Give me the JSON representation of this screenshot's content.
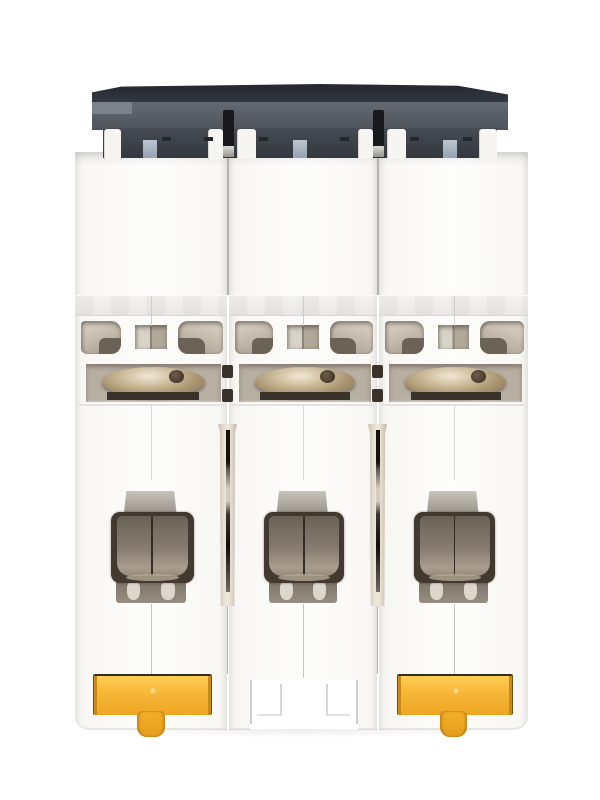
{
  "product": {
    "title": "Three-pole miniature circuit breaker, bottom view on white background",
    "view": "rear/bottom view showing DIN-rail mount and terminals",
    "pole_count": 3
  },
  "colors": {
    "page_bg": "#ffffff",
    "housing": "#f9f8f5",
    "slab_top": "#2e333a",
    "slab_face": "#565b63",
    "slab_tier": "#3d424a",
    "tab_blue": "#aab7c3",
    "pin_black": "#17191d",
    "vent_beige": "#c6bcae",
    "slot_beige": "#b8afa3",
    "screw_bronze": "#a5906f",
    "frame_dark": "#43392f",
    "panel_taupe": "#877c70",
    "metal_silver": "#aaa69c",
    "clip_yellow": "#f7b637",
    "clip_yellow_dark": "#eda622",
    "groove_beige": "#e3dccd"
  },
  "parts": {
    "slab_label": "dark housing top / busbar shroud",
    "module_label": "breaker pole module",
    "vent_label": "ventilation opening",
    "screw_label": "terminal screw head",
    "terminal_label": "wire terminal cage",
    "clip_label": "yellow DIN-rail release clip",
    "recess_label": "DIN-rail slot recess",
    "groove_label": "inter-module groove"
  },
  "modules": [
    {
      "position": "left",
      "din_clip": "yellow"
    },
    {
      "position": "middle",
      "din_clip": "none"
    },
    {
      "position": "right",
      "din_clip": "yellow"
    }
  ]
}
